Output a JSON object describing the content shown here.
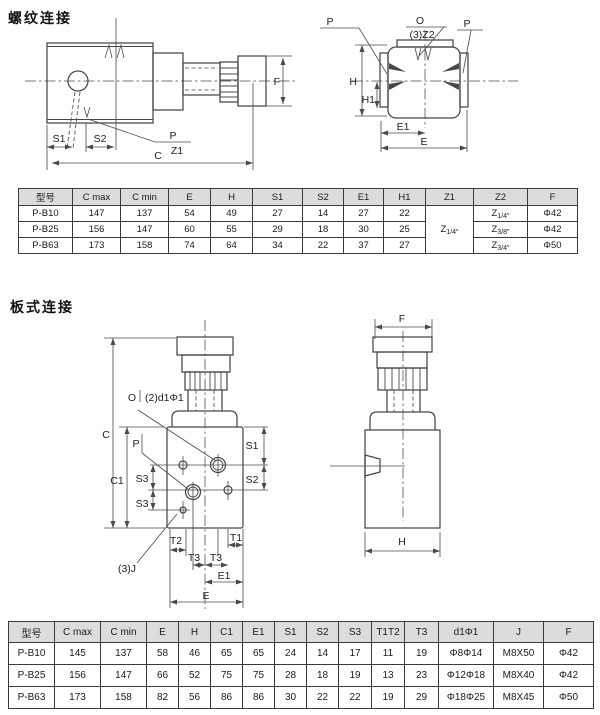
{
  "colors": {
    "line": "#474747",
    "table_border": "#3a3a3a",
    "header_bg": "#dcdcdc",
    "text": "#1a1a1a",
    "bg": "#ffffff"
  },
  "sections": {
    "threaded_title": "螺纹连接",
    "plate_title": "板式连接"
  },
  "threaded_drawing": {
    "side_labels": {
      "s1": "S1",
      "s2": "S2",
      "p": "P",
      "z1": "Z1",
      "c": "C",
      "f": "F"
    },
    "end_labels": {
      "p_left": "P",
      "o": "O",
      "z2_note": "(3)Z2",
      "p_right": "P",
      "h": "H",
      "h1": "H1",
      "e1": "E1",
      "e": "E"
    }
  },
  "plate_drawing": {
    "front_labels": {
      "o": "O",
      "d1_note": "(2)d1Φ1",
      "c": "C",
      "c1": "C1",
      "p": "P",
      "s1": "S1",
      "s2": "S2",
      "s3_upper": "S3",
      "s3_lower": "S3",
      "t2": "T2",
      "t1": "T1",
      "t3_left": "T3",
      "t3_right": "T3",
      "j_note": "(3)J",
      "e1": "E1",
      "e": "E"
    },
    "side_labels": {
      "f": "F",
      "h": "H"
    }
  },
  "t1": {
    "headers": [
      "型号",
      "C max",
      "C min",
      "E",
      "H",
      "S1",
      "S2",
      "E1",
      "H1",
      "Z1",
      "Z2",
      "F"
    ],
    "z1": {
      "base": "Z",
      "sub": "1/4″"
    },
    "rows": [
      {
        "cells": [
          "P-B10",
          "147",
          "137",
          "54",
          "49",
          "27",
          "14",
          "27",
          "22"
        ],
        "z2": {
          "base": "Z",
          "sub": "1/4″"
        },
        "f": "Φ42"
      },
      {
        "cells": [
          "P-B25",
          "156",
          "147",
          "60",
          "55",
          "29",
          "18",
          "30",
          "25"
        ],
        "z2": {
          "base": "Z",
          "sub": "3/8″"
        },
        "f": "Φ42"
      },
      {
        "cells": [
          "P-B63",
          "173",
          "158",
          "74",
          "64",
          "34",
          "22",
          "37",
          "27"
        ],
        "z2": {
          "base": "Z",
          "sub": "3/4″"
        },
        "f": "Φ50"
      }
    ]
  },
  "t2": {
    "headers": [
      "型号",
      "C max",
      "C min",
      "E",
      "H",
      "C1",
      "E1",
      "S1",
      "S2",
      "S3",
      "T1T2",
      "T3",
      "d1Φ1",
      "J",
      "F"
    ],
    "rows": [
      {
        "cells": [
          "P-B10",
          "145",
          "137",
          "58",
          "46",
          "65",
          "65",
          "24",
          "14",
          "17",
          "11",
          "19",
          "Φ8Φ14",
          "M8X50",
          "Φ42"
        ]
      },
      {
        "cells": [
          "P-B25",
          "156",
          "147",
          "66",
          "52",
          "75",
          "75",
          "28",
          "18",
          "19",
          "13",
          "23",
          "Φ12Φ18",
          "M8X40",
          "Φ42"
        ]
      },
      {
        "cells": [
          "P-B63",
          "173",
          "158",
          "82",
          "56",
          "86",
          "86",
          "30",
          "22",
          "22",
          "19",
          "29",
          "Φ18Φ25",
          "M8X45",
          "Φ50"
        ]
      }
    ]
  }
}
